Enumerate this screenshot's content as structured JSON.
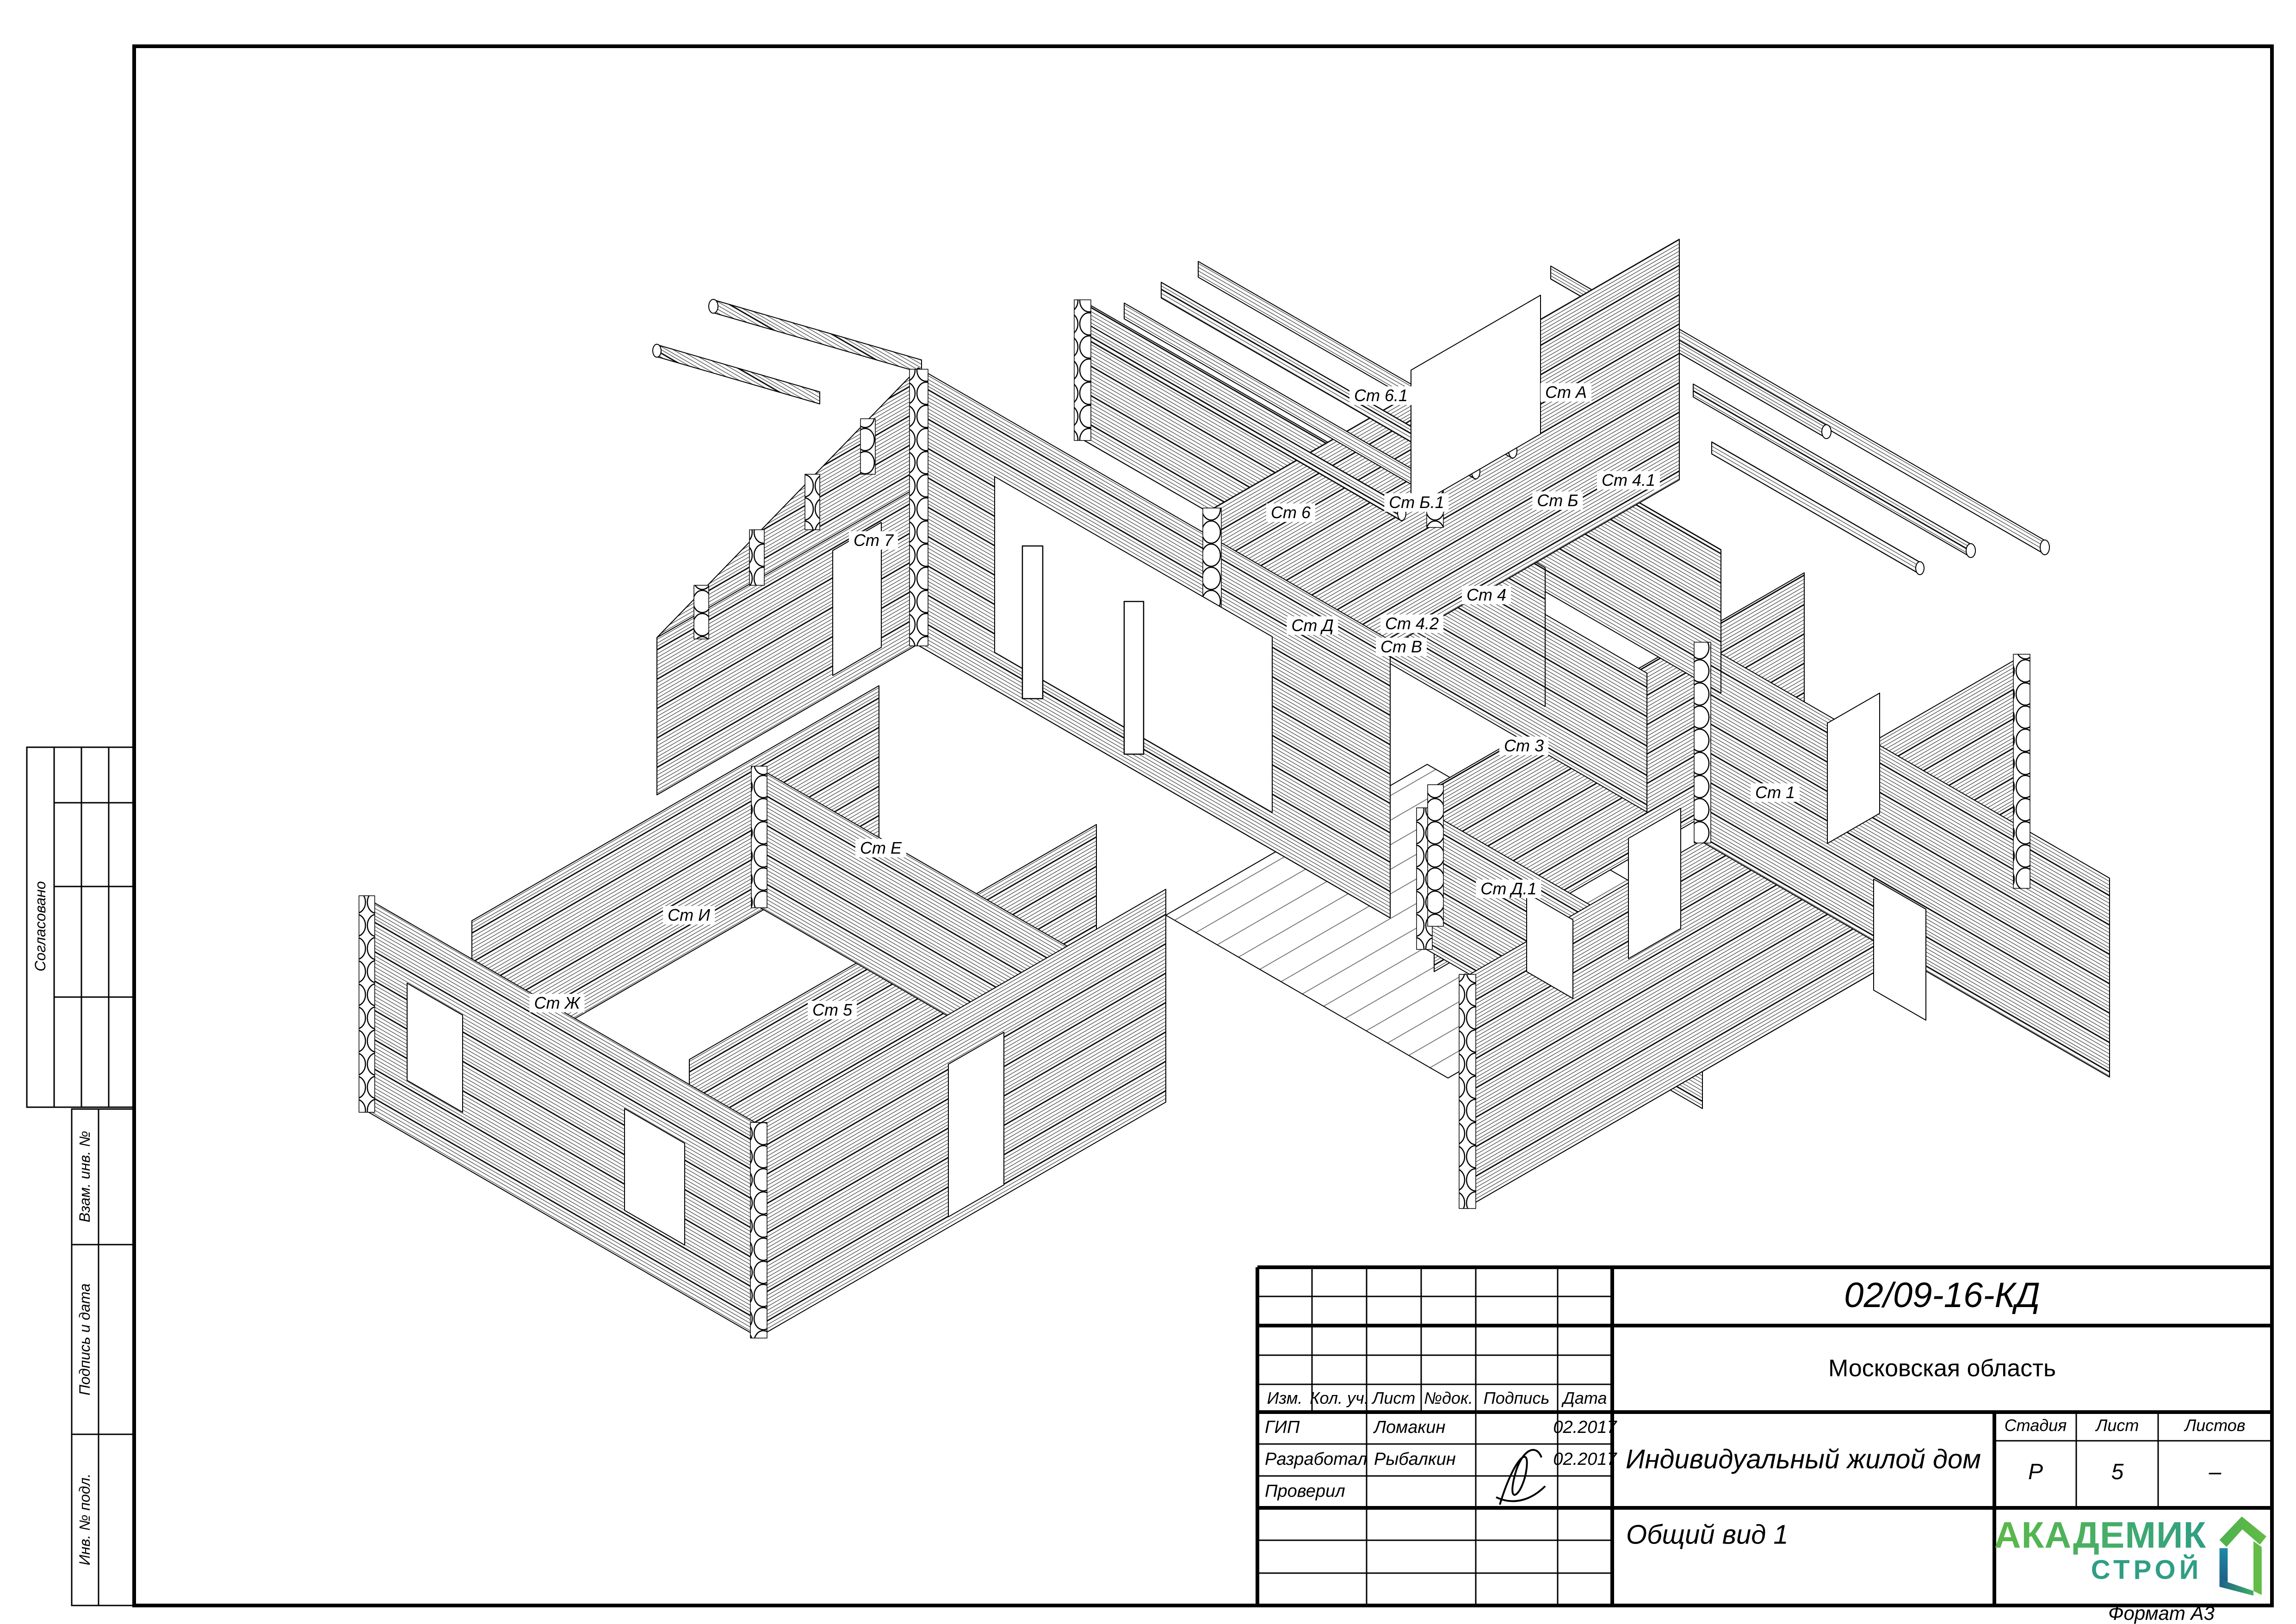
{
  "sheet": {
    "format_note": "Формат А3"
  },
  "side_strip": {
    "approved_label": "Согласовано",
    "stamps": [
      "Взам. инв. №",
      "Подпись и дата",
      "Инв. № подл."
    ]
  },
  "drawing": {
    "view_name": "Общий вид 1",
    "wall_labels": [
      {
        "text": "Ст 6.1"
      },
      {
        "text": "Ст А"
      },
      {
        "text": "Ст 6"
      },
      {
        "text": "Ст Б.1"
      },
      {
        "text": "Ст Б"
      },
      {
        "text": "Ст 4.1"
      },
      {
        "text": "Ст 7"
      },
      {
        "text": "Ст 4"
      },
      {
        "text": "Ст Д"
      },
      {
        "text": "Ст 4.2"
      },
      {
        "text": "Ст В"
      },
      {
        "text": "Ст 3"
      },
      {
        "text": "Ст 1"
      },
      {
        "text": "Ст Е"
      },
      {
        "text": "Ст И"
      },
      {
        "text": "Ст Д.1"
      },
      {
        "text": "Ст Ж"
      },
      {
        "text": "Ст 5"
      }
    ]
  },
  "title_block": {
    "doc_number": "02/09-16-КД",
    "region": "Московская область",
    "object_title": "Индивидуальный жилой дом",
    "view_title": "Общий вид 1",
    "columns": {
      "izm": "Изм.",
      "kol": "Кол. уч.",
      "list": "Лист",
      "ndok": "№док.",
      "podpis": "Подпись",
      "data": "Дата"
    },
    "rows": [
      {
        "role": "ГИП",
        "name": "Ломакин",
        "date": "02.2017"
      },
      {
        "role": "Разработал",
        "name": "Рыбалкин",
        "date": "02.2017"
      },
      {
        "role": "Проверил",
        "name": "",
        "date": ""
      }
    ],
    "stage": {
      "label": "Стадия",
      "value": "Р"
    },
    "sheet_no": {
      "label": "Лист",
      "value": "5"
    },
    "sheets_total": {
      "label": "Листов",
      "value": "–"
    }
  },
  "logo": {
    "line1": "АКАДЕМИК",
    "line2": "СТРОЙ",
    "colors": {
      "green": "#5cb948",
      "teal": "#2f9e85",
      "blue": "#1f89a8",
      "blue_dark": "#1d5f86"
    }
  }
}
